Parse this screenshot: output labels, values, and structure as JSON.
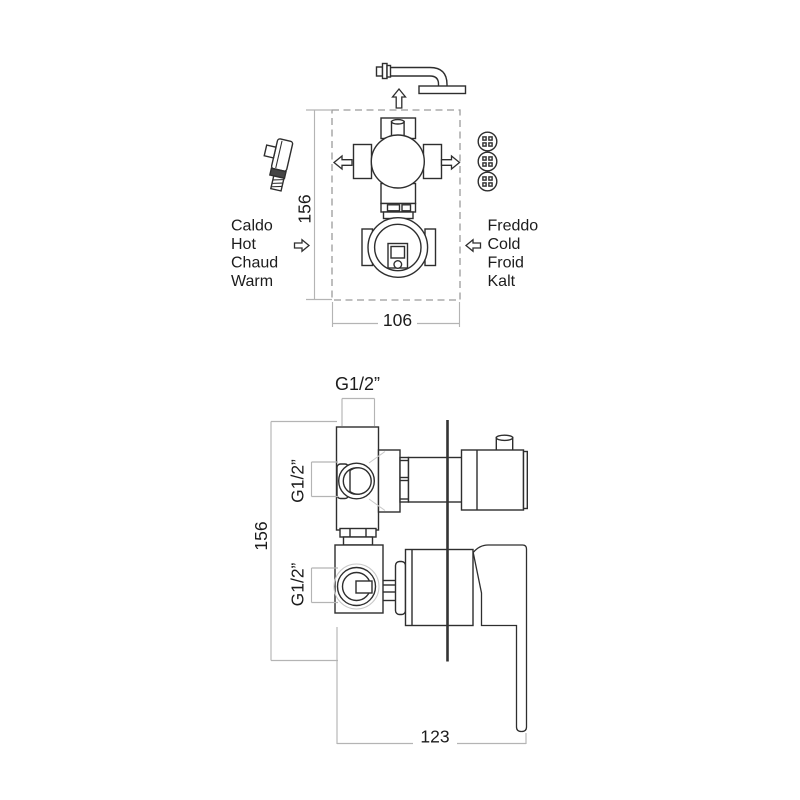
{
  "drawing": {
    "type": "plumbing installation technical diagram",
    "subject": "concealed shower mixer valve with diverter",
    "colors": {
      "line": "#2e2e2e",
      "dimension_line": "#b4b4b4",
      "dashed_box": "#9b9b9b",
      "background": "#ffffff"
    },
    "front_view": {
      "hot_labels": [
        "Caldo",
        "Hot",
        "Chaud",
        "Warm"
      ],
      "cold_labels": [
        "Freddo",
        "Cold",
        "Froid",
        "Kalt"
      ],
      "dim_height": "156",
      "dim_width": "106",
      "icons": [
        "shower-arm-icon",
        "shower-outlet-arrow-icon",
        "hand-shower-icon",
        "hand-shower-arrow-icon",
        "body-jets-icon",
        "body-jets-arrow-icon",
        "hot-inlet-arrow-icon",
        "cold-inlet-arrow-icon"
      ]
    },
    "side_view": {
      "dim_height": "156",
      "dim_depth": "123",
      "thread_top": "G1/2”",
      "thread_upper": "G1/2”",
      "thread_lower": "G1/2”"
    }
  }
}
